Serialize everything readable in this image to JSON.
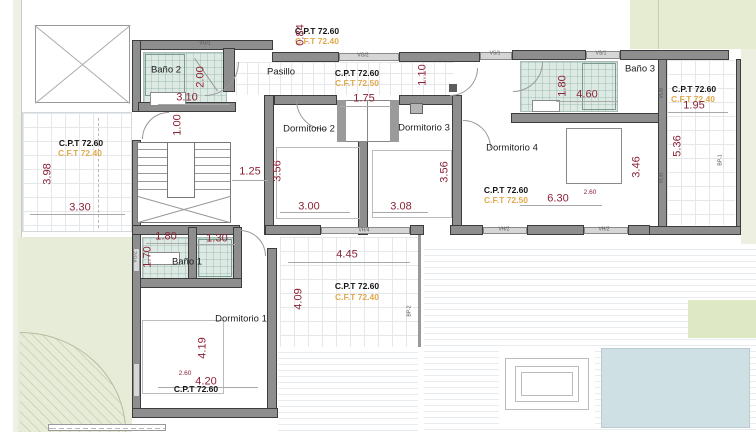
{
  "colors": {
    "wall": "#8e8e8e",
    "dim_text": "#8c2236",
    "cft_text": "#e2a94f",
    "tile": "#ddeae4",
    "garden": "#e7ecd8",
    "accent_green": "#e6ecd2",
    "pool": "#cfe0e5",
    "deck_stripe": "#e8ecef"
  },
  "rooms": {
    "bano1": "Baño 1",
    "bano2": "Baño 2",
    "bano3": "Baño 3",
    "pasillo": "Pasillo",
    "dorm1": "Dormitorio 1",
    "dorm2": "Dormitorio 2",
    "dorm3": "Dormitorio 3",
    "dorm4": "Dormitorio 4"
  },
  "levels": {
    "top": {
      "cpt": "C.P.T 72.60",
      "cft": "C.F.T 72.40"
    },
    "pasillo": {
      "cpt": "C.P.T 72.60",
      "cft": "C.F.T 72.50"
    },
    "terrace_left": {
      "cpt": "C.P.T 72.60",
      "cft": "C.F.T 72.40"
    },
    "terrace_right": {
      "cpt": "C.P.T 72.60",
      "cft": "C.F.T 72.40"
    },
    "terrace_center": {
      "cpt": "C.P.T 72.60",
      "cft": "C.F.T 72.40"
    },
    "dorm4": {
      "cpt": "C.P.T 72.60",
      "cft": "C.F.T 72.50"
    },
    "dorm1": {
      "cpt": "C.P.T 72.60"
    }
  },
  "dims": {
    "bano2_width": "3.10",
    "bano2_depth": "2.00",
    "hall_door": "1.00",
    "top_offset": "0.84",
    "stair_width": "1.25",
    "terrace_left_depth": "3.98",
    "terrace_left_width": "3.30",
    "wardrobe_width": "1.75",
    "hall_width": "1.10",
    "dorm2_depth": "3.56",
    "dorm2_width": "3.00",
    "dorm3_depth": "3.56",
    "dorm3_width": "3.08",
    "bano3_depth": "1.80",
    "bano3_width": "4.60",
    "terrace_right_width": "1.95",
    "terrace_right_depth": "5.36",
    "dorm4_width": "6.30",
    "dorm4_depth": "3.46",
    "dorm4_bed": "2.60",
    "bano1_left": "1.80",
    "bano1_right": "1.30",
    "bano1_door": "1.70",
    "terrace_center_width": "4.45",
    "terrace_center_depth": "4.09",
    "dorm1_depth": "4.19",
    "dorm1_width": "4.20",
    "dorm1_bed": "2.60"
  },
  "wall_tags": {
    "vg1": "VG/1",
    "vg2": "VG/2",
    "vs1": "VS/1",
    "vh2": "VH/2",
    "vh4": "VH/4",
    "vlb": "VL/B",
    "bp1": "BP-1",
    "bp2": "BP-2"
  }
}
